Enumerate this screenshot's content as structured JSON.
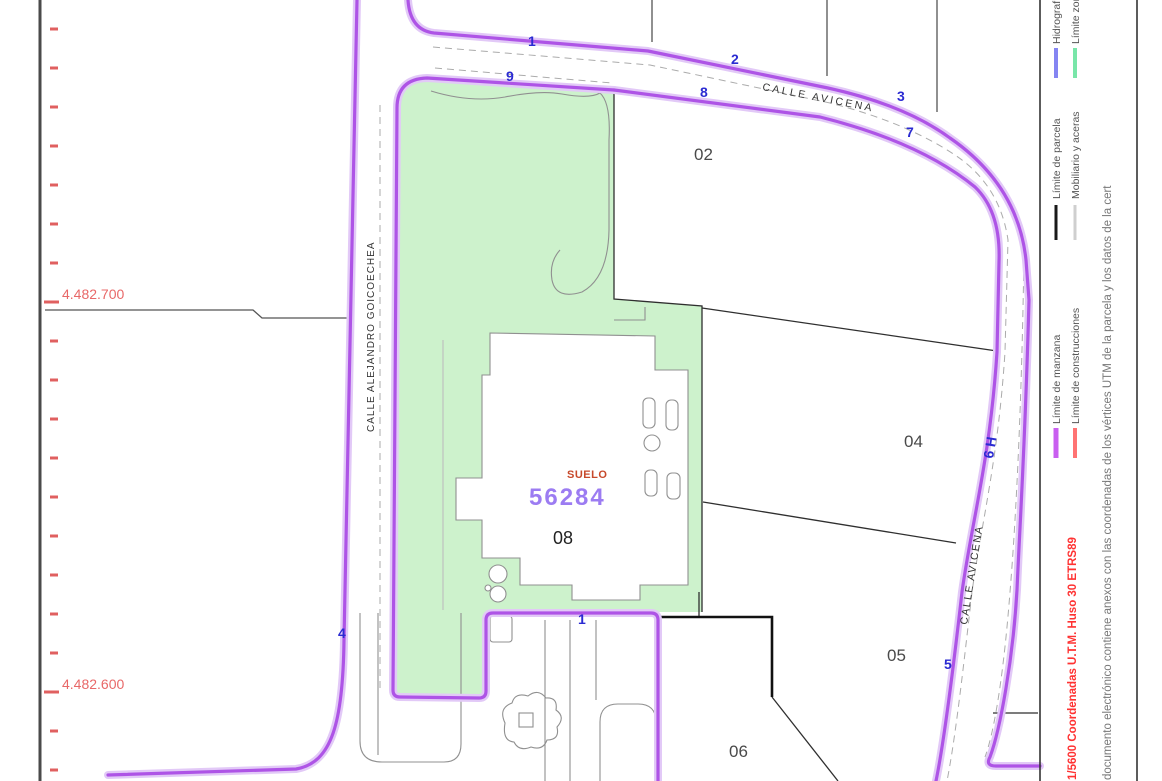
{
  "map": {
    "street_left": "CALLE ALEJANDRO GOICOECHEA",
    "street_top": "CALLE AVICENA",
    "street_right": "CALLE AVICENA",
    "subject_parcel": {
      "soil_label": "SUELO",
      "cadastral_number": "56284",
      "parcel_number": "08"
    },
    "neighbor_parcels": {
      "p02": "02",
      "p04": "04",
      "p05": "05",
      "p06": "06"
    },
    "vertices": {
      "v1_top": "1",
      "v9": "9",
      "v2": "2",
      "v8": "8",
      "v3": "3",
      "v7": "7",
      "v6h": "6 H",
      "v5": "5",
      "v4": "4",
      "v1_bottom": "1"
    },
    "grid_labels": {
      "north_upper": "4.482.700",
      "north_lower": "4.482.600"
    }
  },
  "legend": {
    "items": [
      {
        "label": "Hidrografía",
        "color": "#8585F2"
      },
      {
        "label": "Límite zona verde",
        "color": "#79E6A9"
      },
      {
        "label": "Límite de parcela",
        "color": "#1A1A1A"
      },
      {
        "label": "Mobiliario y aceras",
        "color": "#CFCFCF"
      },
      {
        "label": "Límite de manzana",
        "color": "#C95FF0"
      },
      {
        "label": "Límite de construcciones",
        "color": "#FF7373"
      }
    ]
  },
  "margin_texts": {
    "scale_coords": "1/5600 Coordenadas U.T.M. Huso 30 ETRS89",
    "disclaimer": "documento electrónico contiene anexos con las coordenadas de los vértices UTM de la parcela y los datos de la cert"
  },
  "colors": {
    "manzana": "#AE54E6",
    "manzana_halo": "#E2C9F7",
    "parcel_fill": "#CDF2CC",
    "vertex_blue": "#2B2BD2",
    "coord_red": "#E86868",
    "scale_red": "#FF3232",
    "suelo": "#C7492B",
    "parcel_number_purple": "#9C7CF2"
  }
}
